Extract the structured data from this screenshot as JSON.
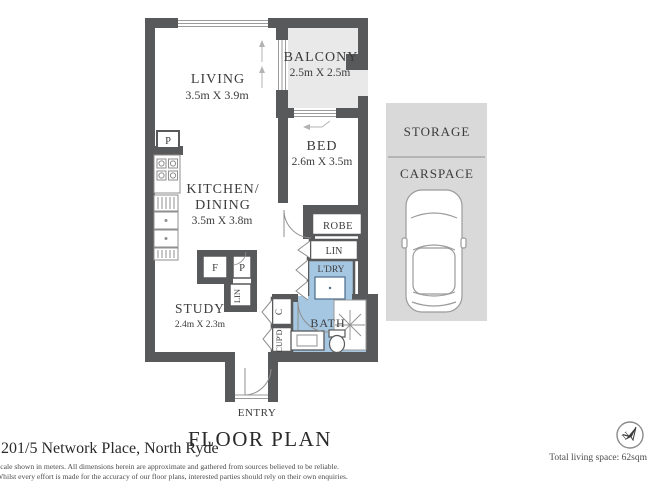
{
  "colors": {
    "wall": "#58595b",
    "wet_area": "#a6c7e2",
    "balcony_fill": "#e9e9e9",
    "carspace_fill": "#d9d9d9",
    "text": "#3c3c3e"
  },
  "plan": {
    "living_label": "LIVING",
    "living_dims": "3.5m X 3.9m",
    "balcony_label": "BALCONY",
    "balcony_dims": "2.5m X 2.5m",
    "bed_label": "BED",
    "bed_dims": "2.6m X 3.5m",
    "kitchen_label_1": "KITCHEN/",
    "kitchen_label_2": "DINING",
    "kitchen_dims": "3.5m X 3.8m",
    "study_label": "STUDY",
    "study_dims": "2.4m X 2.3m",
    "robe_label": "ROBE",
    "linen_label": "LIN",
    "laundry_label": "L'DRY",
    "bath_label": "BATH",
    "cupboard_c_label": "C",
    "cupboard_label": "CUP'D",
    "linen2_label": "LIN",
    "fridge_label": "F",
    "pantry_label": "P",
    "pantry2_label": "P",
    "entry_label": "ENTRY",
    "storage_label": "STORAGE",
    "carspace_label": "CARSPACE"
  },
  "footer": {
    "title": "FLOOR PLAN",
    "address": "1201/5 Network Place, North Ryde",
    "disclaimer_line1": "Scale shown in meters. All dimensions herein are approximate and gathered from sources believed to be reliable.",
    "disclaimer_line2": "Whilst every effort is made for the accuracy of our floor plans, interested parties should rely on their own enquiries.",
    "total_living_space": "Total living space: 62sqm",
    "compass_letter": "N"
  }
}
